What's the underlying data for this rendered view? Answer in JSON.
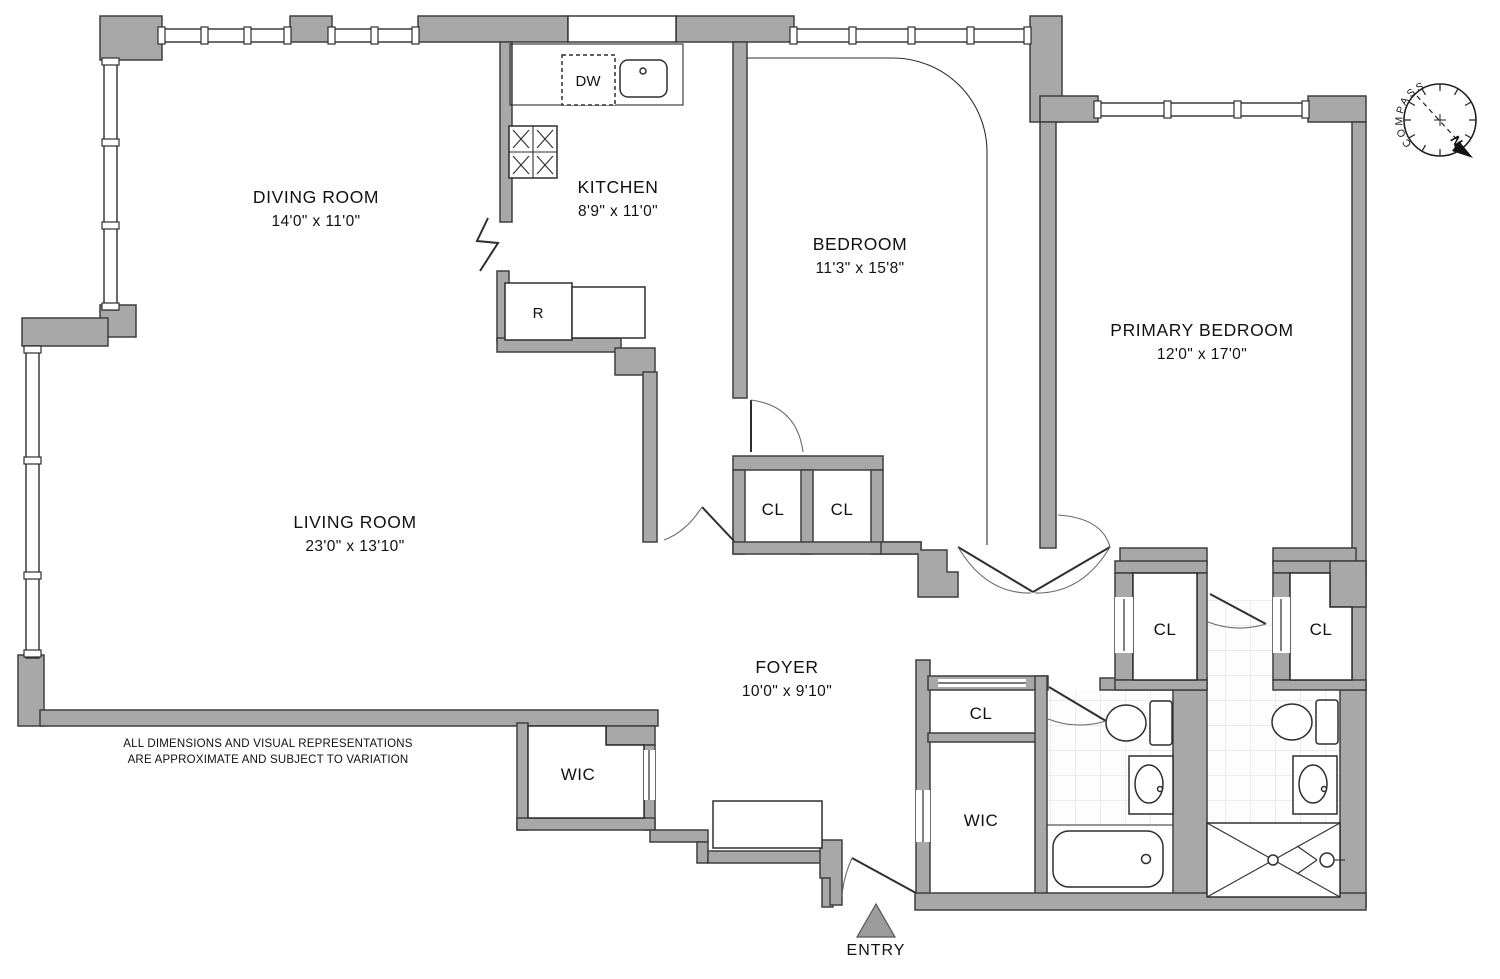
{
  "rooms": [
    {
      "name": "DIVING ROOM",
      "dims": "14'0\" x 11'0\""
    },
    {
      "name": "KITCHEN",
      "dims": "8'9\" x 11'0\""
    },
    {
      "name": "BEDROOM",
      "dims": "11'3\" x 15'8\""
    },
    {
      "name": "PRIMARY BEDROOM",
      "dims": "12'0\" x 17'0\""
    },
    {
      "name": "LIVING ROOM",
      "dims": "23'0\" x 13'10\""
    },
    {
      "name": "FOYER",
      "dims": "10'0\" x 9'10\""
    }
  ],
  "closets": [
    "CL",
    "CL",
    "CL",
    "CL",
    "CL"
  ],
  "walk_in_closets": [
    "WIC",
    "WIC"
  ],
  "appliances": {
    "dishwasher": "DW",
    "refrigerator": "R"
  },
  "entry": {
    "label": "ENTRY"
  },
  "compass": {
    "label": "COMPASS",
    "north_label": "N"
  },
  "disclaimer": {
    "line1": "ALL DIMENSIONS AND VISUAL REPRESENTATIONS",
    "line2": "ARE APPROXIMATE AND SUBJECT TO VARIATION"
  },
  "colors": {
    "wall": "#a8a8a8",
    "wall_outline": "#3f3f3f",
    "north": "#c82020",
    "entry_marker": "#9c9c9c",
    "tile_line": "#dcdcdc"
  }
}
